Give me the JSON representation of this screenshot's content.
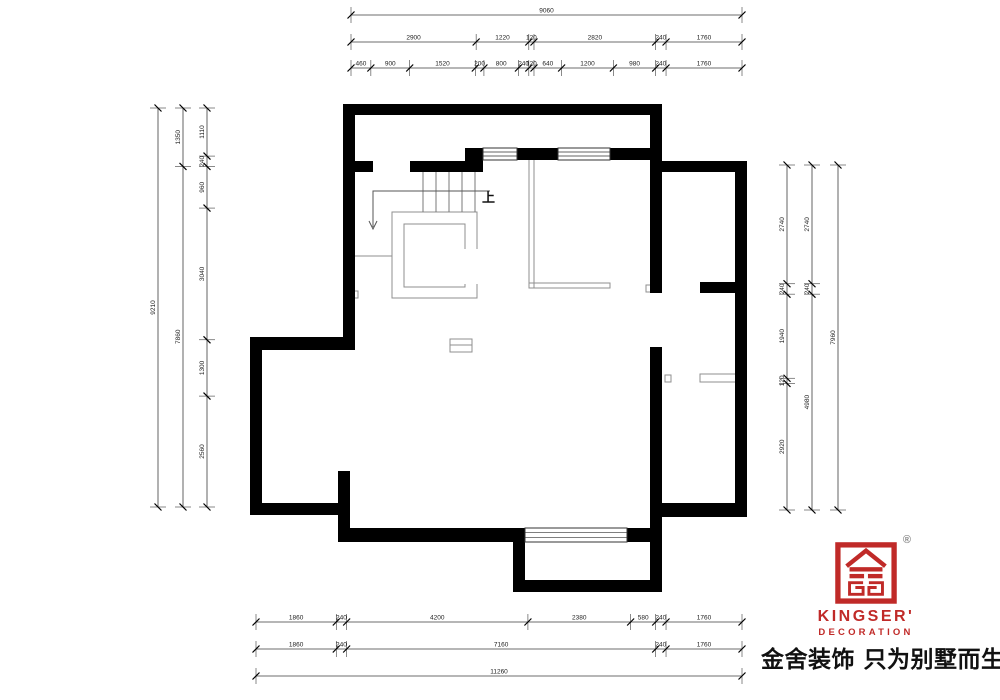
{
  "plan": {
    "up_label": "上",
    "wall_color": "#000000",
    "thin_color": "#8f8f8f",
    "stair_color": "#7a7a7a",
    "dim_line_color": "#3c3c3c",
    "dim_text_color": "#222222",
    "walls": [
      [
        343,
        104,
        319,
        11
      ],
      [
        343,
        104,
        12,
        244
      ],
      [
        355,
        161,
        18,
        11
      ],
      [
        410,
        161,
        65,
        11
      ],
      [
        465,
        148,
        18,
        24
      ],
      [
        517,
        148,
        41,
        12
      ],
      [
        610,
        148,
        42,
        12
      ],
      [
        650,
        104,
        12,
        189
      ],
      [
        650,
        347,
        12,
        245
      ],
      [
        662,
        161,
        85,
        11
      ],
      [
        735,
        161,
        12,
        356
      ],
      [
        700,
        282,
        38,
        11
      ],
      [
        662,
        503,
        85,
        14
      ],
      [
        250,
        337,
        105,
        13
      ],
      [
        250,
        337,
        12,
        178
      ],
      [
        250,
        503,
        100,
        12
      ],
      [
        338,
        471,
        12,
        71
      ],
      [
        338,
        528,
        187,
        14
      ],
      [
        627,
        528,
        23,
        14
      ],
      [
        513,
        540,
        12,
        52
      ],
      [
        513,
        580,
        149,
        12
      ]
    ],
    "windows": [
      [
        483,
        148,
        34,
        12
      ],
      [
        558,
        148,
        52,
        12
      ],
      [
        525,
        528,
        102,
        14
      ]
    ],
    "thin_rects": [
      [
        392,
        212,
        85,
        86
      ],
      [
        404,
        224,
        61,
        63
      ],
      [
        529,
        158,
        5,
        130
      ],
      [
        529,
        283,
        81,
        5
      ],
      [
        450,
        339,
        22,
        13
      ],
      [
        700,
        374,
        37,
        8
      ],
      [
        351,
        291,
        7,
        7
      ],
      [
        646,
        285,
        7,
        7
      ],
      [
        665,
        375,
        6,
        7
      ]
    ],
    "mask_rects": [
      [
        464,
        249,
        15,
        35
      ]
    ],
    "thin_lines": [
      [
        355,
        256,
        392,
        256
      ],
      [
        450,
        345,
        472,
        345
      ]
    ],
    "stair_lines": [
      [
        423,
        172,
        423,
        212
      ],
      [
        436,
        172,
        436,
        212
      ],
      [
        449,
        172,
        449,
        212
      ],
      [
        462,
        172,
        462,
        212
      ],
      [
        475,
        172,
        475,
        212
      ]
    ],
    "arrow": {
      "points": "490,191 373,191 373,227",
      "head": "M369,221 L373,229 L377,221"
    },
    "up_label_pos": [
      482,
      202
    ]
  },
  "dimensions": [
    {
      "dir": "h",
      "at": 15,
      "from": 351,
      "to": 742,
      "values": [
        "9060"
      ]
    },
    {
      "dir": "h",
      "at": 42,
      "from": 351,
      "to": 742,
      "values": [
        "2900",
        "1220",
        "120",
        "2820",
        "240",
        "1760"
      ]
    },
    {
      "dir": "h",
      "at": 68,
      "from": 351,
      "to": 742,
      "values": [
        "460",
        "900",
        "1520",
        "200",
        "800",
        "240",
        "120",
        "640",
        "1200",
        "980",
        "240",
        "1760"
      ]
    },
    {
      "dir": "v",
      "at": 158,
      "from": 108,
      "to": 507,
      "values": [
        "9210"
      ]
    },
    {
      "dir": "v",
      "at": 183,
      "from": 108,
      "to": 507,
      "values": [
        "1350",
        "7860"
      ]
    },
    {
      "dir": "v",
      "at": 207,
      "from": 108,
      "to": 507,
      "values": [
        "1110",
        "240",
        "960",
        "3040",
        "1300",
        "2560"
      ]
    },
    {
      "dir": "v",
      "at": 787,
      "from": 165,
      "to": 510,
      "values": [
        "2740",
        "240",
        "1940",
        "120",
        "2920"
      ]
    },
    {
      "dir": "v",
      "at": 812,
      "from": 165,
      "to": 510,
      "values": [
        "2740",
        "240",
        "4980"
      ]
    },
    {
      "dir": "v",
      "at": 838,
      "from": 165,
      "to": 510,
      "values": [
        "7960"
      ]
    },
    {
      "dir": "h",
      "at": 622,
      "from": 256,
      "to": 742,
      "values": [
        "1860",
        "240",
        "4200",
        "2380",
        "580",
        "240",
        "1760"
      ]
    },
    {
      "dir": "h",
      "at": 649,
      "from": 256,
      "to": 742,
      "values": [
        "1860",
        "240",
        "7160",
        "240",
        "1760"
      ]
    },
    {
      "dir": "h",
      "at": 676,
      "from": 256,
      "to": 742,
      "values": [
        "11260"
      ]
    }
  ],
  "logo": {
    "brand": "KINGSER'",
    "subtitle": "DECORATION",
    "registered": "®",
    "tagline": "金舍装饰 只为别墅而生。",
    "red": "#c02a28"
  }
}
